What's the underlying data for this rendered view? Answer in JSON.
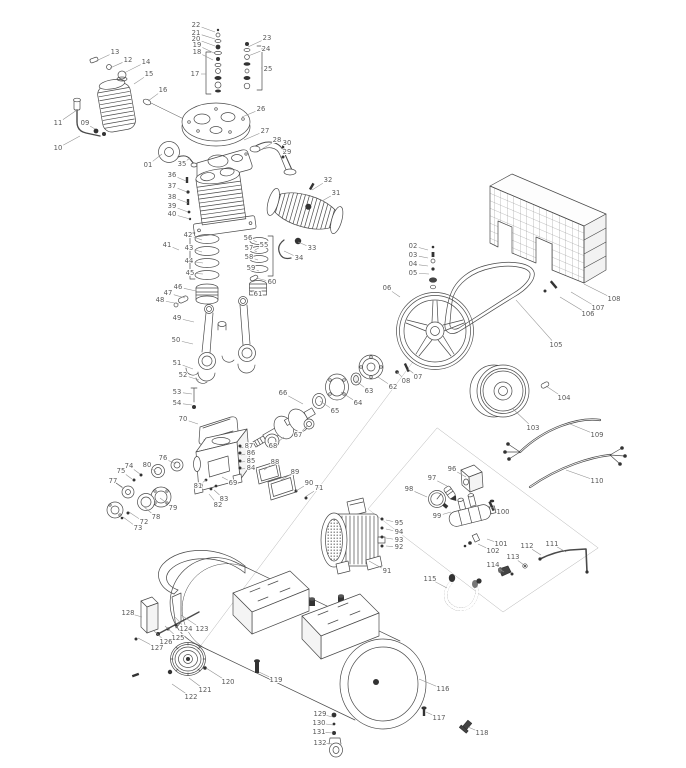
{
  "diagram": {
    "type": "exploded-parts-diagram",
    "colors": {
      "background": "#ffffff",
      "line": "#4a4a4a",
      "dark_fill": "#333333",
      "label_text": "#5a5a5a",
      "leader_line": "#8f8f8f",
      "construction_line": "#b3b3b3"
    },
    "label_format": [
      "part_number",
      "x",
      "y",
      "leader_x",
      "leader_y"
    ],
    "labels": [
      [
        "01",
        148,
        165,
        162,
        154
      ],
      [
        "02",
        413,
        246,
        428,
        250
      ],
      [
        "03",
        413,
        255,
        428,
        258
      ],
      [
        "04",
        413,
        264,
        428,
        266
      ],
      [
        "05",
        413,
        273,
        429,
        274
      ],
      [
        "06",
        387,
        288,
        400,
        297
      ],
      [
        "07",
        418,
        377,
        408,
        369
      ],
      [
        "08",
        406,
        381,
        397,
        372
      ],
      [
        "09",
        85,
        123,
        95,
        129
      ],
      [
        "10",
        58,
        148,
        80,
        136
      ],
      [
        "11",
        58,
        123,
        77,
        110
      ],
      [
        "12",
        128,
        60,
        110,
        68
      ],
      [
        "13",
        115,
        52,
        96,
        61
      ],
      [
        "14",
        146,
        62,
        124,
        73
      ],
      [
        "15",
        149,
        74,
        134,
        84
      ],
      [
        "16",
        163,
        90,
        148,
        101
      ],
      [
        "17",
        195,
        74,
        206,
        74
      ],
      [
        "18",
        197,
        52,
        213,
        60
      ],
      [
        "19",
        197,
        45,
        214,
        53
      ],
      [
        "20",
        196,
        39,
        215,
        46
      ],
      [
        "21",
        196,
        33,
        215,
        39
      ],
      [
        "22",
        196,
        25,
        215,
        32
      ],
      [
        "23",
        267,
        38,
        248,
        47
      ],
      [
        "24",
        266,
        49,
        248,
        56
      ],
      [
        "25",
        268,
        69,
        261,
        68
      ],
      [
        "26",
        261,
        109,
        242,
        117
      ],
      [
        "27",
        265,
        131,
        244,
        140
      ],
      [
        "28",
        277,
        140,
        262,
        149
      ],
      [
        "29",
        287,
        152,
        284,
        158
      ],
      [
        "30",
        287,
        143,
        284,
        149
      ],
      [
        "31",
        336,
        193,
        322,
        201
      ],
      [
        "32",
        328,
        180,
        312,
        190
      ],
      [
        "33",
        312,
        248,
        298,
        242
      ],
      [
        "34",
        299,
        258,
        284,
        251
      ],
      [
        "35",
        182,
        164,
        190,
        158
      ],
      [
        "36",
        172,
        175,
        186,
        181
      ],
      [
        "37",
        172,
        186,
        187,
        192
      ],
      [
        "38",
        172,
        197,
        188,
        203
      ],
      [
        "39",
        172,
        206,
        188,
        212
      ],
      [
        "40",
        172,
        214,
        190,
        219
      ],
      [
        "41",
        167,
        245,
        179,
        250
      ],
      [
        "42",
        188,
        235,
        202,
        240
      ],
      [
        "43",
        189,
        248,
        202,
        252
      ],
      [
        "44",
        189,
        261,
        203,
        263
      ],
      [
        "45",
        190,
        273,
        203,
        274
      ],
      [
        "46",
        178,
        287,
        196,
        291
      ],
      [
        "47",
        168,
        293,
        185,
        298
      ],
      [
        "48",
        160,
        300,
        179,
        304
      ],
      [
        "49",
        177,
        318,
        194,
        322
      ],
      [
        "50",
        176,
        340,
        193,
        344
      ],
      [
        "51",
        177,
        363,
        193,
        369
      ],
      [
        "52",
        183,
        375,
        199,
        380
      ],
      [
        "53",
        177,
        392,
        192,
        394
      ],
      [
        "54",
        177,
        403,
        192,
        405
      ],
      [
        "55",
        264,
        245,
        255,
        250
      ],
      [
        "56",
        248,
        238,
        257,
        242
      ],
      [
        "57",
        249,
        248,
        257,
        252
      ],
      [
        "58",
        249,
        257,
        258,
        260
      ],
      [
        "59",
        251,
        268,
        259,
        271
      ],
      [
        "60",
        272,
        282,
        256,
        278
      ],
      [
        "61",
        258,
        294,
        249,
        291
      ],
      [
        "62",
        393,
        387,
        378,
        377
      ],
      [
        "63",
        369,
        391,
        356,
        381
      ],
      [
        "64",
        358,
        403,
        341,
        392
      ],
      [
        "65",
        335,
        411,
        320,
        401
      ],
      [
        "66",
        283,
        393,
        303,
        404
      ],
      [
        "67",
        298,
        435,
        308,
        425
      ],
      [
        "68",
        273,
        446,
        284,
        437
      ],
      [
        "69",
        233,
        483,
        222,
        477
      ],
      [
        "70",
        183,
        419,
        198,
        424
      ],
      [
        "71",
        319,
        488,
        305,
        497
      ],
      [
        "72",
        144,
        522,
        129,
        512
      ],
      [
        "73",
        138,
        528,
        123,
        517
      ],
      [
        "74",
        129,
        466,
        140,
        474
      ],
      [
        "75",
        121,
        471,
        132,
        479
      ],
      [
        "76",
        163,
        458,
        176,
        464
      ],
      [
        "77",
        113,
        481,
        124,
        489
      ],
      [
        "78",
        156,
        517,
        143,
        506
      ],
      [
        "79",
        173,
        508,
        160,
        498
      ],
      [
        "80",
        147,
        465,
        156,
        472
      ],
      [
        "81",
        198,
        486,
        206,
        480
      ],
      [
        "82",
        218,
        505,
        209,
        494
      ],
      [
        "83",
        224,
        499,
        214,
        490
      ],
      [
        "84",
        251,
        468,
        241,
        469
      ],
      [
        "85",
        251,
        461,
        241,
        462
      ],
      [
        "86",
        251,
        453,
        241,
        455
      ],
      [
        "87",
        249,
        446,
        240,
        448
      ],
      [
        "88",
        275,
        462,
        264,
        470
      ],
      [
        "89",
        295,
        472,
        281,
        480
      ],
      [
        "90",
        309,
        483,
        296,
        491
      ],
      [
        "91",
        387,
        571,
        369,
        561
      ],
      [
        "92",
        399,
        547,
        386,
        546
      ],
      [
        "93",
        399,
        540,
        386,
        538
      ],
      [
        "94",
        399,
        532,
        386,
        529
      ],
      [
        "95",
        399,
        523,
        386,
        520
      ],
      [
        "96",
        452,
        469,
        466,
        477
      ],
      [
        "97",
        432,
        478,
        447,
        486
      ],
      [
        "98",
        409,
        489,
        427,
        497
      ],
      [
        "99",
        437,
        516,
        451,
        512
      ],
      [
        "100",
        503,
        512,
        488,
        506
      ],
      [
        "101",
        501,
        544,
        487,
        539
      ],
      [
        "102",
        493,
        551,
        478,
        544
      ],
      [
        "103",
        533,
        428,
        512,
        408
      ],
      [
        "104",
        564,
        398,
        546,
        386
      ],
      [
        "105",
        556,
        345,
        516,
        300
      ],
      [
        "106",
        588,
        314,
        560,
        297
      ],
      [
        "107",
        598,
        308,
        571,
        292
      ],
      [
        "108",
        614,
        299,
        584,
        284
      ],
      [
        "109",
        597,
        435,
        570,
        424
      ],
      [
        "110",
        597,
        481,
        566,
        470
      ],
      [
        "111",
        552,
        544,
        566,
        552
      ],
      [
        "112",
        527,
        546,
        541,
        555
      ],
      [
        "113",
        513,
        557,
        524,
        565
      ],
      [
        "114",
        493,
        565,
        504,
        572
      ],
      [
        "115",
        430,
        579,
        447,
        588
      ],
      [
        "116",
        443,
        689,
        419,
        679
      ],
      [
        "117",
        439,
        718,
        426,
        712
      ],
      [
        "118",
        482,
        733,
        468,
        727
      ],
      [
        "119",
        276,
        680,
        259,
        672
      ],
      [
        "120",
        228,
        682,
        206,
        668
      ],
      [
        "121",
        205,
        690,
        189,
        678
      ],
      [
        "122",
        191,
        697,
        172,
        684
      ],
      [
        "123",
        202,
        629,
        181,
        615
      ],
      [
        "124",
        186,
        629,
        175,
        617
      ],
      [
        "125",
        178,
        638,
        165,
        626
      ],
      [
        "126",
        166,
        642,
        154,
        631
      ],
      [
        "127",
        157,
        648,
        138,
        638
      ],
      [
        "128",
        128,
        613,
        142,
        617
      ],
      [
        "129",
        320,
        714,
        333,
        717
      ],
      [
        "130",
        319,
        723,
        333,
        725
      ],
      [
        "131",
        319,
        732,
        333,
        733
      ],
      [
        "132",
        320,
        743,
        333,
        744
      ]
    ]
  }
}
